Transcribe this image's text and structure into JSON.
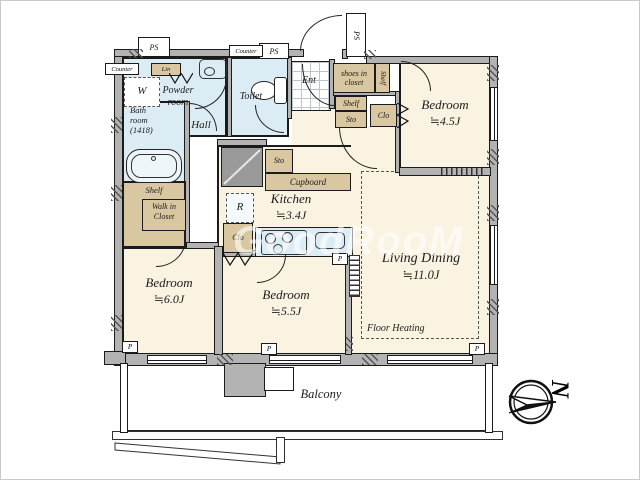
{
  "colors": {
    "floor": "#faf3e2",
    "wet": "#dcecf4",
    "tan": "#d8c7a0",
    "wall": "#b3b3b3",
    "line": "#1b1b1b",
    "duct": "#9a9a9a"
  },
  "rooms": {
    "bedroom1": {
      "name": "Bedroom",
      "size": "≒4.5J"
    },
    "bedroom2": {
      "name": "Bedroom",
      "size": "≒6.0J"
    },
    "bedroom3": {
      "name": "Bedroom",
      "size": "≒5.5J"
    },
    "living": {
      "name": "Living Dining",
      "size": "≒11.0J",
      "note": "Floor Heating"
    },
    "kitchen": {
      "name": "Kitchen",
      "size": "≒3.4J"
    },
    "bath": {
      "l1": "Bath",
      "l2": "room",
      "l3": "(1418)"
    },
    "powder": {
      "l1": "Powder",
      "l2": "room"
    },
    "toilet": {
      "name": "Toilet"
    },
    "hall": {
      "name": "Hall"
    },
    "entrance": {
      "name": "Ent"
    },
    "balcony": {
      "name": "Balcony"
    },
    "wic": {
      "l1": "Walk in",
      "l2": "Closet"
    },
    "shoes": {
      "l1": "shoes in",
      "l2": "closet"
    }
  },
  "fixtures": {
    "ps": "PS",
    "counter": "Counter",
    "lin": "Lin",
    "washer": "W",
    "shelf": "Shelf",
    "sto": "Sto",
    "clo": "Clo",
    "cupboard": "Cupboard",
    "fridge": "R",
    "pillar": "P"
  },
  "compass": {
    "letter": "N"
  },
  "watermark": {
    "text": "GoodRooM"
  }
}
